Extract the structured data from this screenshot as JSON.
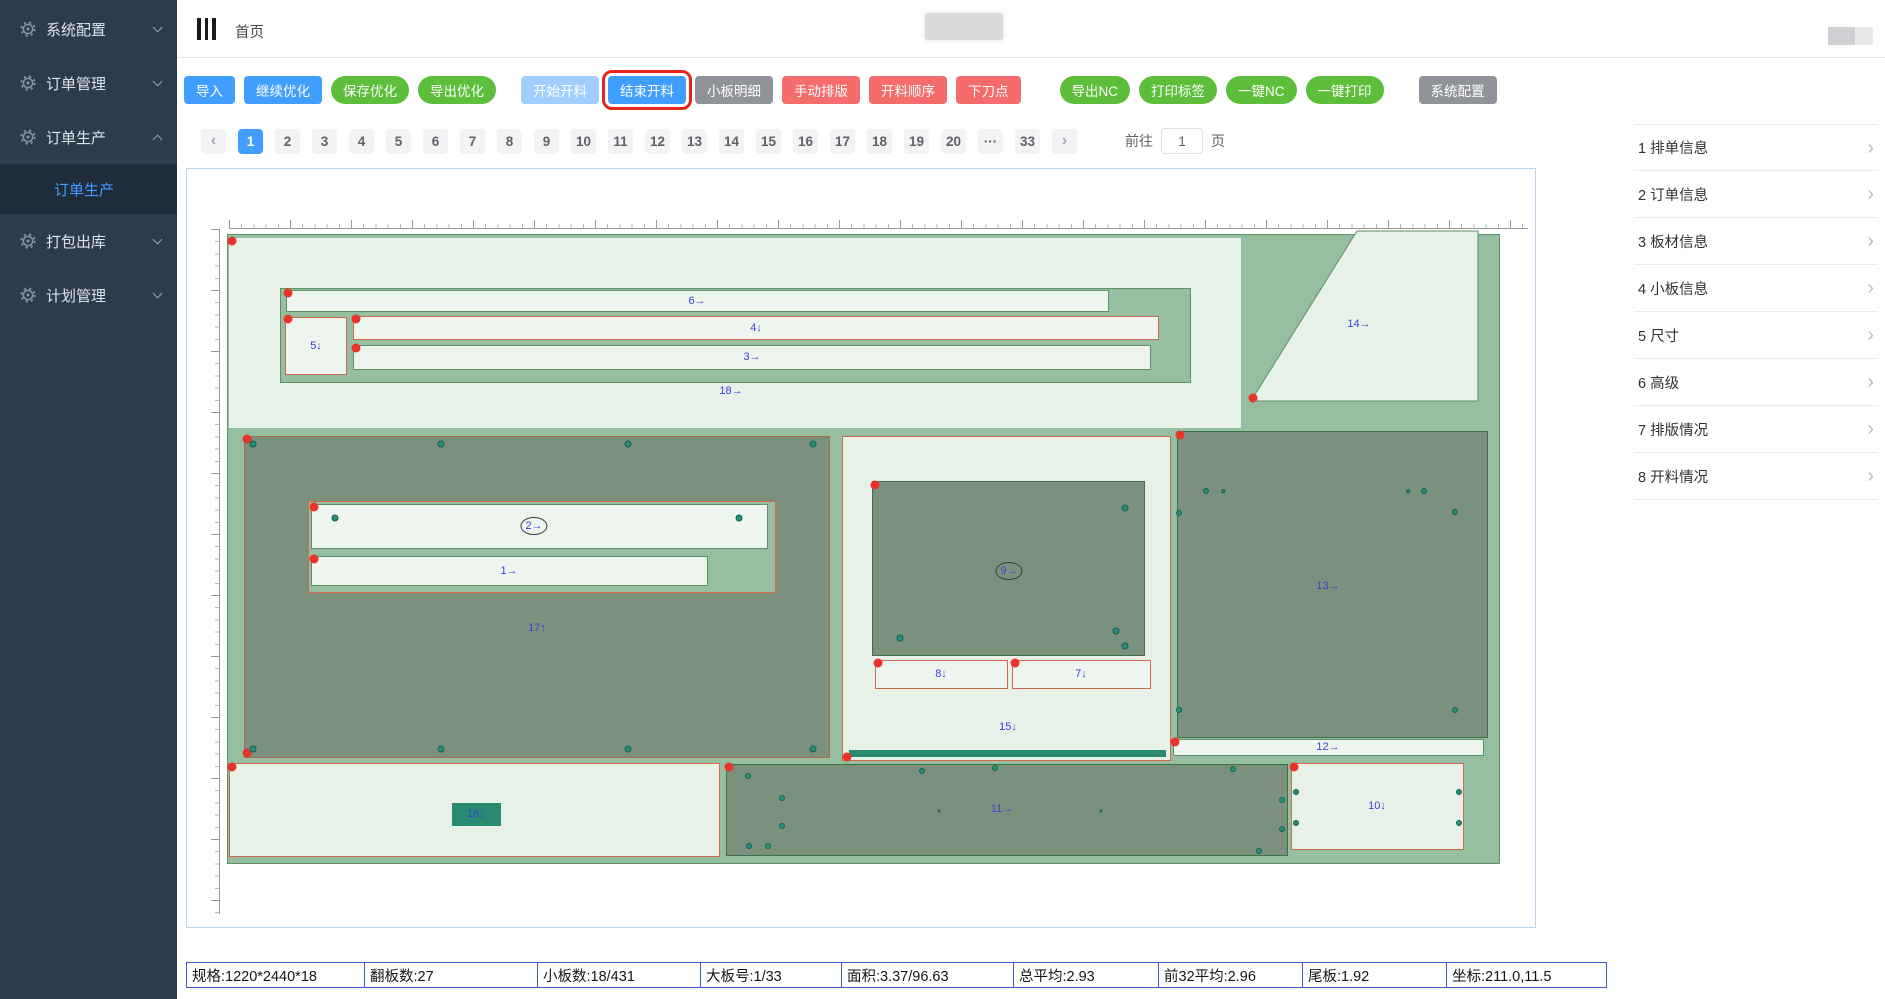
{
  "sidebar": {
    "bg": "#2e3b4d",
    "active_color": "#3f9eff",
    "items": [
      {
        "label": "系统配置",
        "expanded": false
      },
      {
        "label": "订单管理",
        "expanded": false
      },
      {
        "label": "订单生产",
        "expanded": true,
        "children": [
          {
            "label": "订单生产",
            "active": true
          }
        ]
      },
      {
        "label": "打包出库",
        "expanded": false
      },
      {
        "label": "计划管理",
        "expanded": false
      }
    ]
  },
  "header": {
    "breadcrumb": "首页"
  },
  "toolbar": {
    "colors": {
      "blue": "#409eff",
      "blue_light": "#a0cfff",
      "green": "#5cbe3a",
      "red": "#f56c6c",
      "gray": "#909399",
      "highlight_border": "#e8251b"
    },
    "buttons": [
      {
        "label": "导入",
        "style": "blue"
      },
      {
        "label": "继续优化",
        "style": "blue"
      },
      {
        "label": "保存优化",
        "style": "green"
      },
      {
        "label": "导出优化",
        "style": "green"
      },
      {
        "label": "开始开料",
        "style": "blue-light",
        "gap": 16
      },
      {
        "label": "结束开料",
        "style": "blue",
        "highlight": true
      },
      {
        "label": "小板明细",
        "style": "gray"
      },
      {
        "label": "手动排版",
        "style": "red"
      },
      {
        "label": "开料顺序",
        "style": "red"
      },
      {
        "label": "下刀点",
        "style": "red"
      },
      {
        "label": "导出NC",
        "style": "green",
        "gap": 30
      },
      {
        "label": "打印标签",
        "style": "green"
      },
      {
        "label": "一键NC",
        "style": "green"
      },
      {
        "label": "一键打印",
        "style": "green"
      },
      {
        "label": "系统配置",
        "style": "gray",
        "gap": 26
      }
    ]
  },
  "pagination": {
    "prev": "‹",
    "next": "›",
    "pages": [
      "1",
      "2",
      "3",
      "4",
      "5",
      "6",
      "7",
      "8",
      "9",
      "10",
      "11",
      "12",
      "13",
      "14",
      "15",
      "16",
      "17",
      "18",
      "19",
      "20",
      "···",
      "33"
    ],
    "active": "1",
    "goto_prefix": "前往",
    "goto_value": "1",
    "goto_suffix": "页"
  },
  "right_panel": {
    "items": [
      {
        "index": "1",
        "label": "排单信息"
      },
      {
        "index": "2",
        "label": "订单信息"
      },
      {
        "index": "3",
        "label": "板材信息"
      },
      {
        "index": "4",
        "label": "小板信息"
      },
      {
        "index": "5",
        "label": "尺寸"
      },
      {
        "index": "6",
        "label": "高级"
      },
      {
        "index": "7",
        "label": "排版情况"
      },
      {
        "index": "8",
        "label": "开料情况"
      }
    ]
  },
  "status_bar": {
    "border_color": "#3e57c9",
    "cells": [
      {
        "label": "规格",
        "value": "1220*2440*18"
      },
      {
        "label": "翻板数",
        "value": "27"
      },
      {
        "label": "小板数",
        "value": "18/431"
      },
      {
        "label": "大板号",
        "value": "1/33"
      },
      {
        "label": "面积",
        "value": "3.37/96.63"
      },
      {
        "label": "总平均",
        "value": "2.93"
      },
      {
        "label": "前32平均",
        "value": "2.96"
      },
      {
        "label": "尾板",
        "value": "1.92"
      },
      {
        "label": "坐标",
        "value": "211.0,11.5"
      }
    ]
  },
  "canvas": {
    "palette": {
      "board": "#95bfa0",
      "light": "#e7f1e8",
      "lighter": "#eef5ee",
      "dark": "#7c907e",
      "teal": "#2a8a70",
      "label": "#3642d6",
      "red_dot": "#e8352b",
      "drill": "#259178"
    },
    "borders": {
      "green": "#5f9066",
      "darkgreen": "#3d7249",
      "salmon": "#cf6a4d",
      "rust": "#b06a4f"
    },
    "rects": [
      {
        "name": "board",
        "x": 40,
        "y": 65,
        "w": 1273,
        "h": 630,
        "fill": "board",
        "border": "green"
      },
      {
        "name": "piece-18",
        "x": 42,
        "y": 69,
        "w": 1012,
        "h": 190,
        "fill": "light"
      },
      {
        "name": "panel-18-inner",
        "x": 93,
        "y": 119,
        "w": 911,
        "h": 95,
        "fill": "board",
        "border": "green"
      },
      {
        "name": "strip-6",
        "x": 99,
        "y": 121,
        "w": 823,
        "h": 22,
        "fill": "lighter",
        "border": "green"
      },
      {
        "name": "piece-5",
        "x": 98,
        "y": 148,
        "w": 62,
        "h": 58,
        "fill": "lighter",
        "border": "salmon"
      },
      {
        "name": "strip-4",
        "x": 166,
        "y": 147,
        "w": 806,
        "h": 24,
        "fill": "lighter",
        "border": "salmon"
      },
      {
        "name": "strip-3",
        "x": 166,
        "y": 176,
        "w": 798,
        "h": 25,
        "fill": "lighter",
        "border": "green"
      },
      {
        "name": "piece-17",
        "x": 57,
        "y": 267,
        "w": 586,
        "h": 322,
        "fill": "dark",
        "border": "rust"
      },
      {
        "name": "group-17-inner",
        "x": 121,
        "y": 332,
        "w": 468,
        "h": 92,
        "fill": "board",
        "border": "salmon"
      },
      {
        "name": "strip-2",
        "x": 124,
        "y": 335,
        "w": 457,
        "h": 45,
        "fill": "lighter",
        "border": "green"
      },
      {
        "name": "strip-1",
        "x": 124,
        "y": 387,
        "w": 397,
        "h": 30,
        "fill": "lighter",
        "border": "green"
      },
      {
        "name": "piece-15",
        "x": 655,
        "y": 267,
        "w": 329,
        "h": 325,
        "fill": "light",
        "border": "salmon"
      },
      {
        "name": "piece-9",
        "x": 685,
        "y": 312,
        "w": 273,
        "h": 175,
        "fill": "dark",
        "border": "darkgreen"
      },
      {
        "name": "strip-8",
        "x": 688,
        "y": 491,
        "w": 133,
        "h": 29,
        "fill": "lighter",
        "border": "salmon"
      },
      {
        "name": "strip-7",
        "x": 825,
        "y": 491,
        "w": 139,
        "h": 29,
        "fill": "lighter",
        "border": "salmon"
      },
      {
        "name": "cut-bar",
        "x": 662,
        "y": 581,
        "w": 317,
        "h": 7,
        "fill": "teal"
      },
      {
        "name": "piece-13",
        "x": 990,
        "y": 262,
        "w": 311,
        "h": 307,
        "fill": "dark",
        "border": "darkgreen"
      },
      {
        "name": "strip-12",
        "x": 986,
        "y": 570,
        "w": 311,
        "h": 17,
        "fill": "lighter",
        "border": "green"
      },
      {
        "name": "piece-bottom-left",
        "x": 42,
        "y": 594,
        "w": 491,
        "h": 94,
        "fill": "light",
        "border": "salmon"
      },
      {
        "name": "piece-11",
        "x": 539,
        "y": 595,
        "w": 562,
        "h": 92,
        "fill": "dark",
        "border": "darkgreen"
      },
      {
        "name": "piece-10",
        "x": 1104,
        "y": 594,
        "w": 173,
        "h": 87,
        "fill": "light",
        "border": "salmon"
      },
      {
        "name": "piece-16",
        "x": 265,
        "y": 634,
        "w": 49,
        "h": 23,
        "fill": "teal"
      }
    ],
    "polygon": {
      "name": "piece-14",
      "points": "1170,62 1291,62 1291,232 1064,232",
      "fill": "light",
      "border": "green"
    },
    "labels": [
      {
        "text": "6→",
        "x": 510,
        "y": 132
      },
      {
        "text": "5↓",
        "x": 129,
        "y": 177
      },
      {
        "text": "4↓",
        "x": 569,
        "y": 159
      },
      {
        "text": "3→",
        "x": 565,
        "y": 188
      },
      {
        "text": "18→",
        "x": 544,
        "y": 222
      },
      {
        "text": "14→",
        "x": 1172,
        "y": 155
      },
      {
        "text": "2→",
        "x": 347,
        "y": 357,
        "circled": true
      },
      {
        "text": "1→",
        "x": 322,
        "y": 402
      },
      {
        "text": "17↑",
        "x": 350,
        "y": 459
      },
      {
        "text": "9→",
        "x": 822,
        "y": 402,
        "circled": true
      },
      {
        "text": "8↓",
        "x": 754,
        "y": 505
      },
      {
        "text": "7↓",
        "x": 894,
        "y": 505
      },
      {
        "text": "15↓",
        "x": 821,
        "y": 558
      },
      {
        "text": "13→",
        "x": 1141,
        "y": 417
      },
      {
        "text": "12→",
        "x": 1141,
        "y": 578
      },
      {
        "text": "16↓",
        "x": 289,
        "y": 645
      },
      {
        "text": "11→",
        "x": 815,
        "y": 640
      },
      {
        "text": "10↓",
        "x": 1190,
        "y": 637
      }
    ],
    "red_dots": [
      [
        45,
        72
      ],
      [
        101,
        124
      ],
      [
        101,
        150
      ],
      [
        169,
        150
      ],
      [
        169,
        179
      ],
      [
        1066,
        229
      ],
      [
        60,
        270
      ],
      [
        60,
        584
      ],
      [
        127,
        338
      ],
      [
        127,
        390
      ],
      [
        688,
        316
      ],
      [
        691,
        494
      ],
      [
        828,
        494
      ],
      [
        660,
        588
      ],
      [
        993,
        266
      ],
      [
        988,
        573
      ],
      [
        45,
        598
      ],
      [
        542,
        598
      ],
      [
        1107,
        598
      ]
    ],
    "drill_dots": [
      [
        66,
        275,
        3.5
      ],
      [
        254,
        275,
        3.5
      ],
      [
        441,
        275,
        3.5
      ],
      [
        626,
        275,
        3.5
      ],
      [
        66,
        580,
        3.5
      ],
      [
        254,
        580,
        3.5
      ],
      [
        441,
        580,
        3.5
      ],
      [
        626,
        580,
        3.5
      ],
      [
        148,
        349,
        3.5
      ],
      [
        552,
        349,
        3.5
      ],
      [
        938,
        339,
        3.5
      ],
      [
        713,
        469,
        3.5
      ],
      [
        929,
        462,
        3.5
      ],
      [
        938,
        477,
        3.5
      ],
      [
        1019,
        322,
        3
      ],
      [
        1036,
        322,
        1.8
      ],
      [
        1221,
        322,
        1.8
      ],
      [
        1237,
        322,
        3
      ],
      [
        992,
        344,
        3
      ],
      [
        1268,
        343,
        3
      ],
      [
        992,
        541,
        3
      ],
      [
        1268,
        541,
        3
      ],
      [
        561,
        607,
        3
      ],
      [
        735,
        602,
        3
      ],
      [
        808,
        599,
        3
      ],
      [
        1046,
        600,
        3
      ],
      [
        1095,
        631,
        3
      ],
      [
        1095,
        660,
        3
      ],
      [
        595,
        629,
        3
      ],
      [
        595,
        657,
        3
      ],
      [
        562,
        677,
        3
      ],
      [
        581,
        677,
        3
      ],
      [
        1072,
        682,
        3
      ],
      [
        752,
        642,
        1.5
      ],
      [
        914,
        642,
        1.5
      ],
      [
        1109,
        623,
        3
      ],
      [
        1272,
        623,
        3
      ],
      [
        1109,
        654,
        3
      ],
      [
        1272,
        654,
        3
      ]
    ]
  }
}
